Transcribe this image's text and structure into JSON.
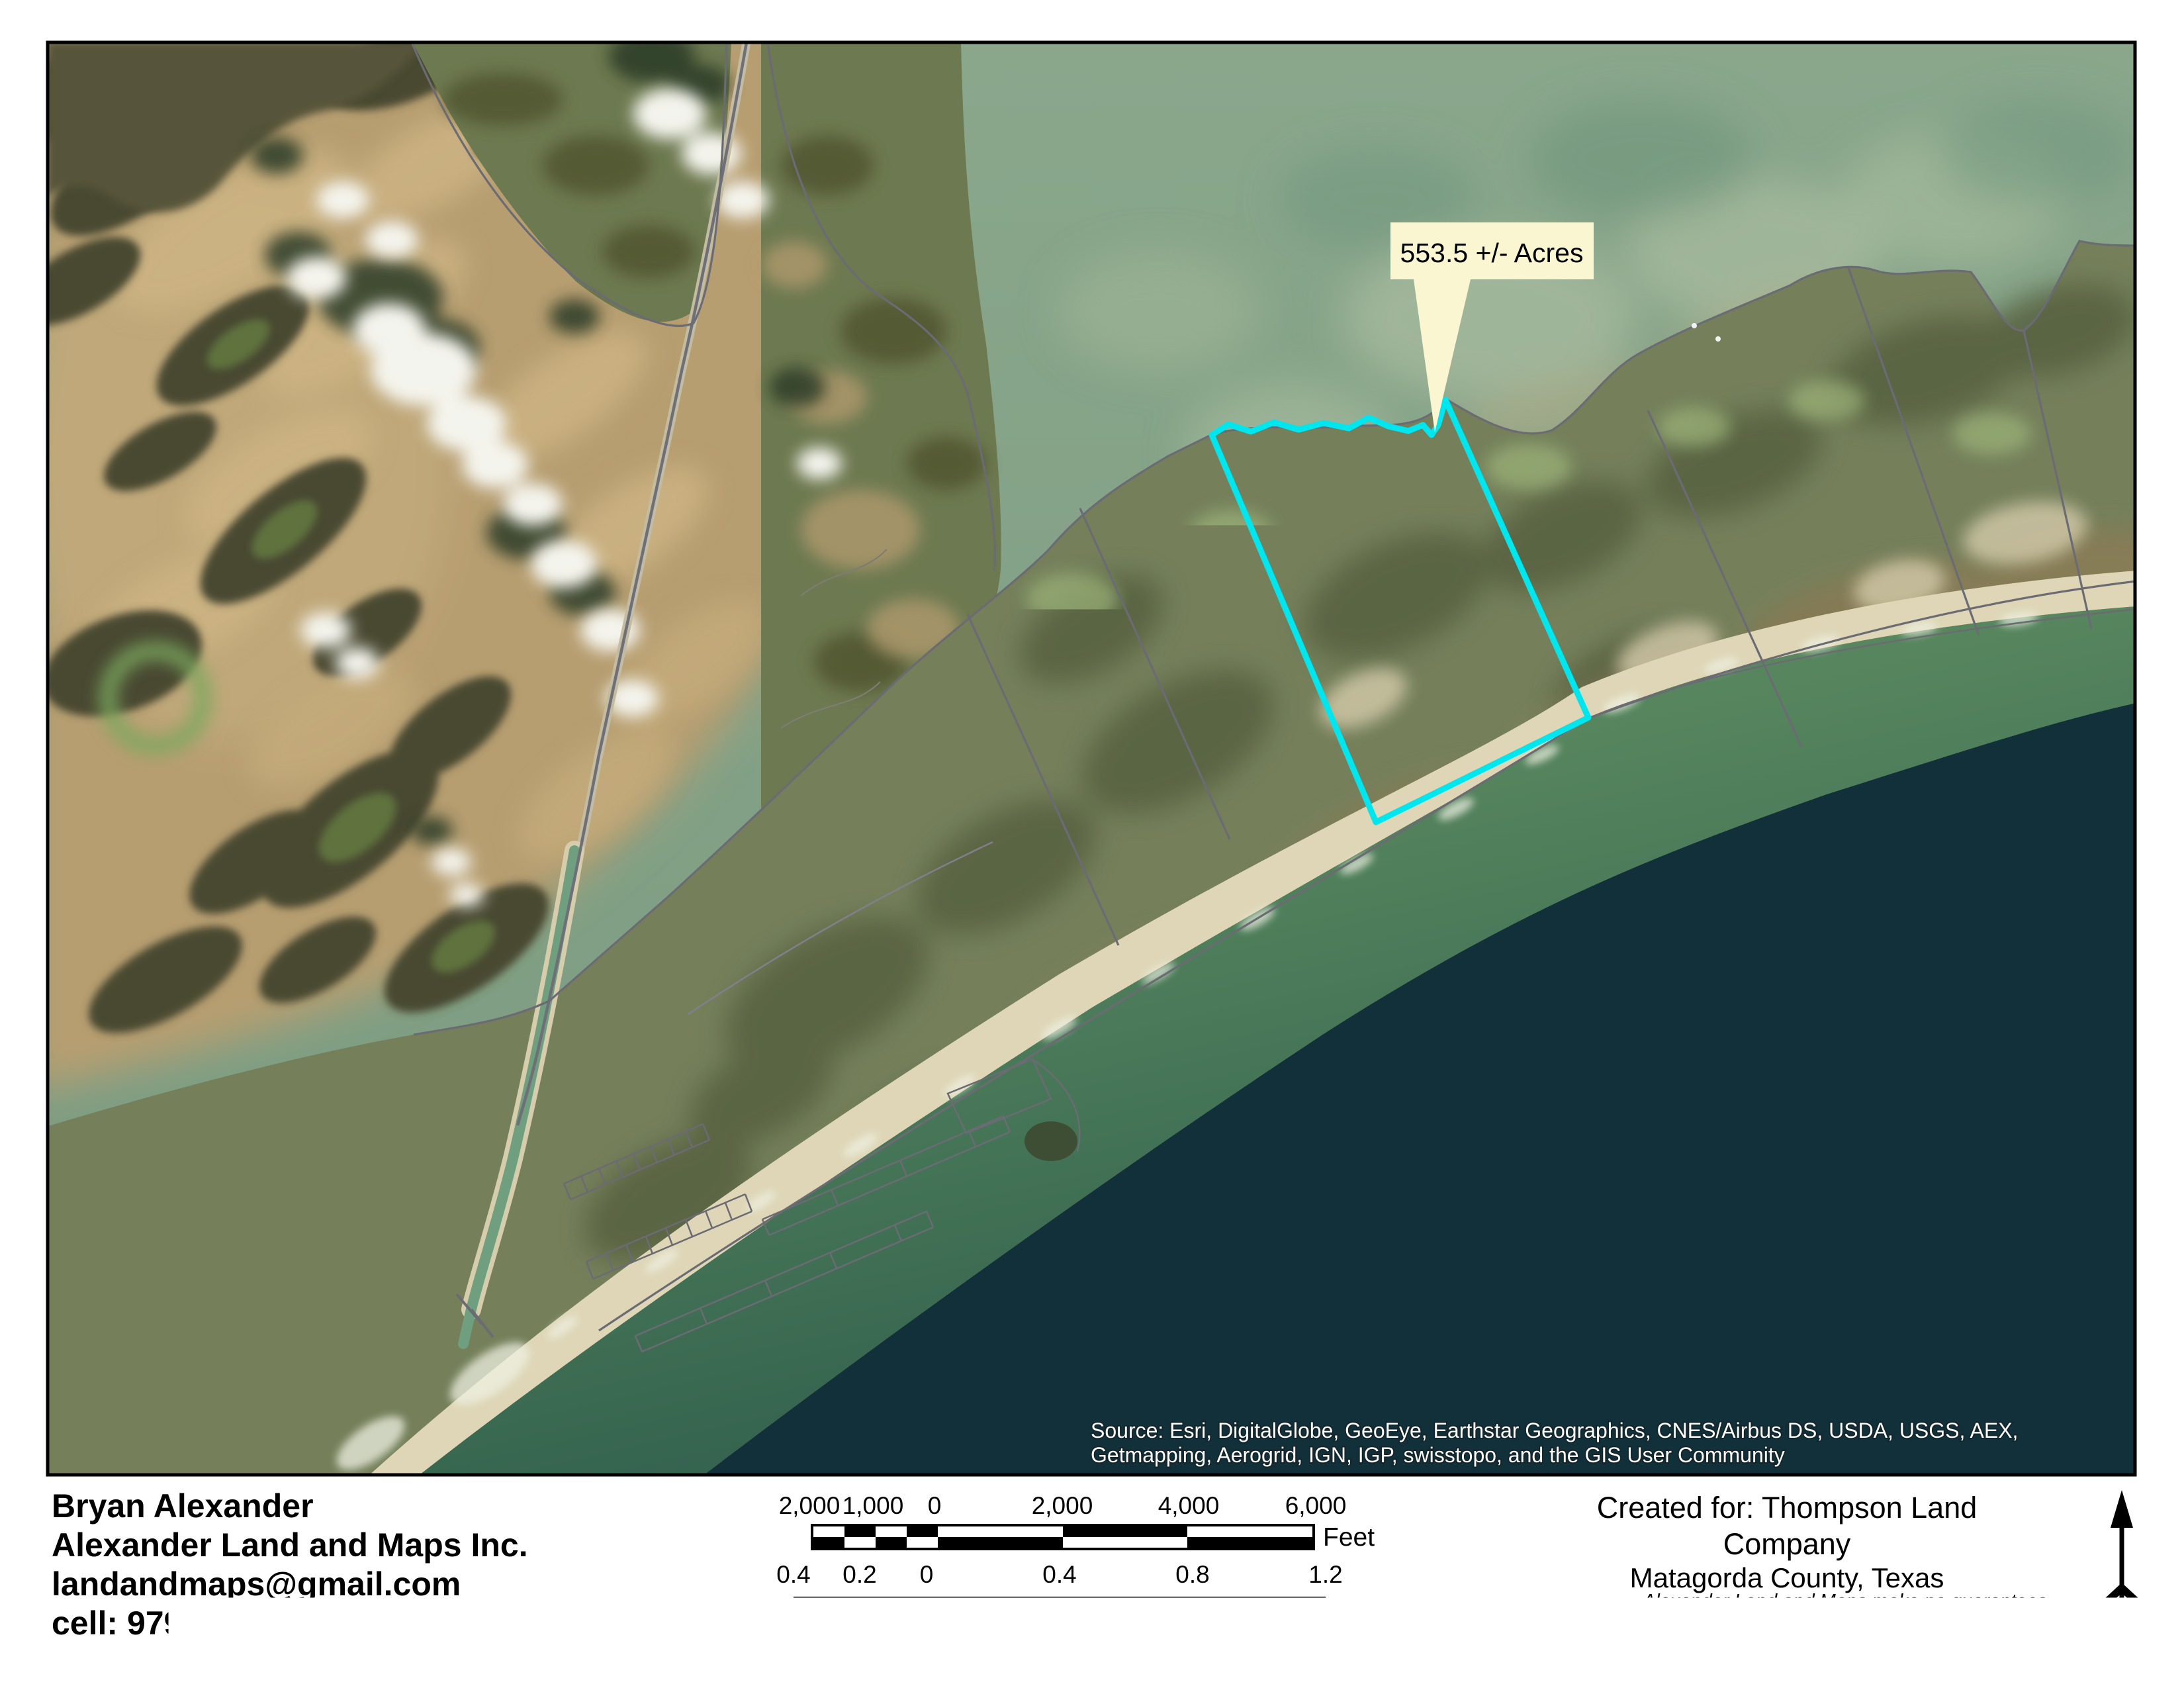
{
  "map": {
    "callout": {
      "label": "553.5 +/- Acres"
    },
    "source_credit": {
      "line1": "Source: Esri, DigitalGlobe, GeoEye, Earthstar Geographics, CNES/Airbus DS, USDA, USGS, AEX,",
      "line2": "Getmapping, Aerogrid, IGN, IGP, swisstopo, and the GIS User Community"
    },
    "colors": {
      "parcel_outline": "#00e6ef",
      "callout_fill": "#f9f6d1",
      "deep_gulf": "#12303a",
      "bay_water": "#84a186",
      "mud_bay": "#b79e71",
      "island": "#75805b",
      "beach": "#ded6b6",
      "boundary_gray": "#6b6b73"
    }
  },
  "footer": {
    "contact": {
      "line1": "Bryan Alexander",
      "line2": "Alexander Land and Maps Inc.",
      "line3": "landandmaps@gmail.com",
      "line4": "cell: 979-479-9447"
    },
    "date": "11/30/2018",
    "scale_bars": {
      "feet": {
        "labels": [
          "2,000",
          "1,000",
          "0",
          "2,000",
          "4,000",
          "6,000"
        ],
        "unit": "Feet"
      },
      "miles": {
        "labels": [
          "0.4",
          "0.2",
          "0",
          "0.4",
          "0.8",
          "1.2"
        ],
        "unit": "Miles"
      }
    },
    "created_for": {
      "line1": "Created for: Thompson Land Company",
      "line2": "Matagorda County, Texas",
      "line3": "East Matagorda Island"
    },
    "disclaimer": {
      "line1": "Alexander Land and Maps make no guarantees",
      "line2": "to the accuracy of this document.",
      "line3": "All data must be verified by the user."
    }
  }
}
